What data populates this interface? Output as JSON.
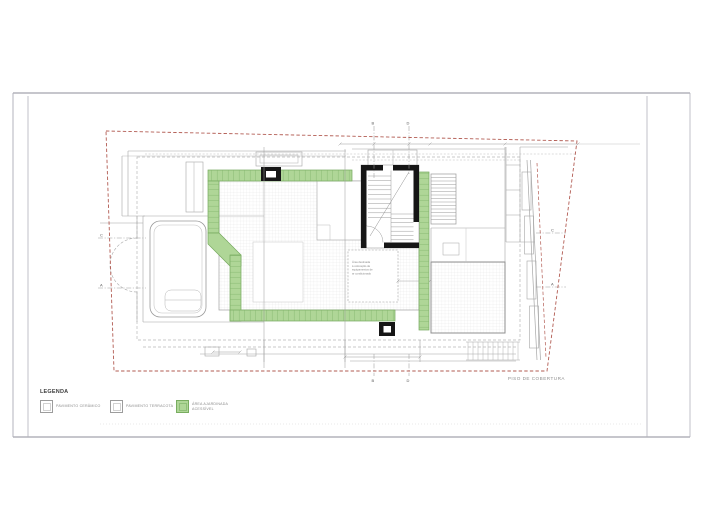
{
  "drawing": {
    "title": "PISO DE COBERTURA",
    "annotation_lines": [
      "Área destinada",
      "à colocação de",
      "equipamentos de",
      "ar condicionado"
    ]
  },
  "legend": {
    "title": "LEGENDA",
    "items": [
      {
        "label": "PAVIMENTO CERÂMICO"
      },
      {
        "label": "PAVIMENTO TERRACOTA"
      },
      {
        "label": "ÁREA AJARDINADA\nACESSÍVEL"
      }
    ]
  },
  "section_markers": {
    "top_b": "B",
    "top_d": "D",
    "bottom_b": "B",
    "bottom_d": "D",
    "left_c": "C",
    "left_a": "A",
    "right_c": "C",
    "right_a": "A"
  },
  "colors": {
    "site_boundary": "#b25b52",
    "garden_fill": "#afd697",
    "garden_stroke": "#76a95e",
    "structure_black": "#161616",
    "outline_gray": "#a6a6a6"
  }
}
